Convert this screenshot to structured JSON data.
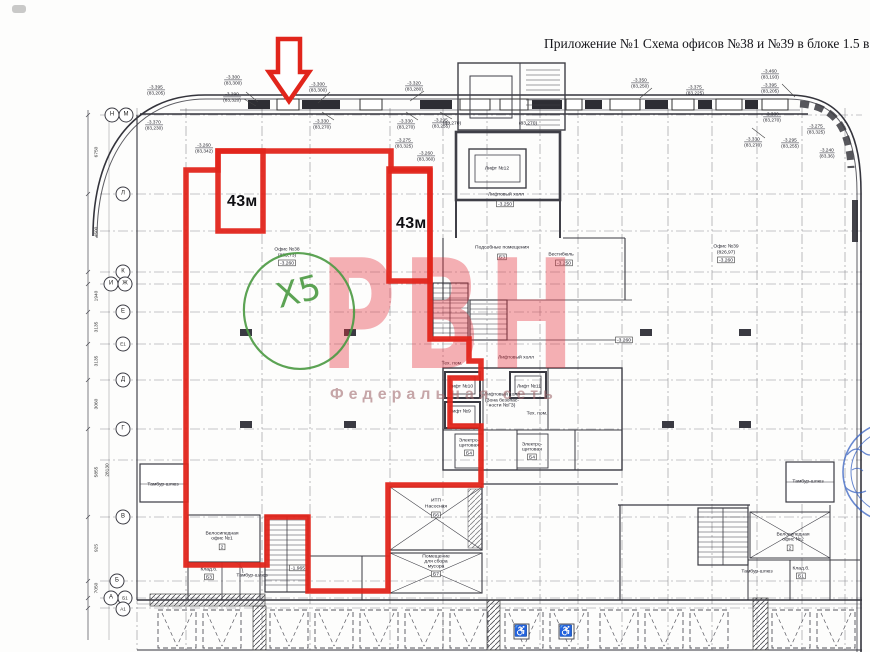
{
  "document": {
    "title": "Приложение №1 Схема офисов №38 и №39 в блоке 1.5 в"
  },
  "markup": {
    "area_label_1": "43м",
    "area_label_2": "43м",
    "green_mark": "Х5"
  },
  "watermark": {
    "logo": "РВН",
    "subtitle": "Федеральная сеть"
  },
  "offices": [
    {
      "name": "Офис №38",
      "area": "(835,73)",
      "elevation": "-3.260"
    },
    {
      "name": "Офис №39",
      "area": "(826,97)",
      "elevation": "-3.260"
    }
  ],
  "rooms": [
    {
      "label": "Лифт №12"
    },
    {
      "label": "Лифтовый холл"
    },
    {
      "label": "-3.250"
    },
    {
      "label": "Подсобные помещения"
    },
    {
      "label": "Б3"
    },
    {
      "label": "Вестибюль"
    },
    {
      "label": "-3.250"
    },
    {
      "label": "Лифтовый холл"
    },
    {
      "label": "Тех. пом."
    },
    {
      "label": "Лифт №10"
    },
    {
      "label": "Лифт №9"
    },
    {
      "label": "Лифт №11"
    },
    {
      "label": "Лифтовый холл"
    },
    {
      "label": "(Зона безопас-"
    },
    {
      "label": "ности №ГЗ)"
    },
    {
      "label": "Тех. пом."
    },
    {
      "label": "Электро-"
    },
    {
      "label": "щитовая"
    },
    {
      "label": "Б4"
    },
    {
      "label": "Электро-"
    },
    {
      "label": "щитовая"
    },
    {
      "label": "Б4"
    },
    {
      "label": "ИТП"
    },
    {
      "label": "Насосная"
    },
    {
      "label": "Б6"
    },
    {
      "label": "Помещение"
    },
    {
      "label": "для сбора"
    },
    {
      "label": "мусора"
    },
    {
      "label": "Б7"
    },
    {
      "label": "Велосипедная"
    },
    {
      "label": "офис №1"
    },
    {
      "label": "2"
    },
    {
      "label": "Велосипедная"
    },
    {
      "label": "офис №2"
    },
    {
      "label": "2"
    },
    {
      "label": "Клад.б."
    },
    {
      "label": "Б3"
    },
    {
      "label": "Клад.б."
    },
    {
      "label": "Б1"
    },
    {
      "label": "Тамбур-шлюз"
    },
    {
      "label": "Тамбур-шлюз"
    },
    {
      "label": "Тамбур-шлюз"
    },
    {
      "label": "Тамбур-шлюз"
    },
    {
      "label": "-1.965"
    },
    {
      "label": "-3.260"
    },
    {
      "label": "(83,270)"
    },
    {
      "label": "(83,270)"
    }
  ],
  "elevations": [
    {
      "value": "-3.395",
      "mark": "(83,205)"
    },
    {
      "value": "-3.370",
      "mark": "(83,230)"
    },
    {
      "value": "-3.300",
      "mark": "(83,300)"
    },
    {
      "value": "-3.290",
      "mark": "(83,320)"
    },
    {
      "value": "-3.260",
      "mark": "(83,342)"
    },
    {
      "value": "-3.300",
      "mark": "(83,300)"
    },
    {
      "value": "-3.330",
      "mark": "(83,270)"
    },
    {
      "value": "-3.320",
      "mark": "(83,280)"
    },
    {
      "value": "-3.330",
      "mark": "(83,270)"
    },
    {
      "value": "-3.295",
      "mark": "(83,255)"
    },
    {
      "value": "-3.275",
      "mark": "(83,325)"
    },
    {
      "value": "-3.260",
      "mark": "(83,360)"
    },
    {
      "value": "-3.350",
      "mark": "(83,250)"
    },
    {
      "value": "-3.375",
      "mark": "(83,225)"
    },
    {
      "value": "-3.460",
      "mark": "(83,193)"
    },
    {
      "value": "-3.395",
      "mark": "(83,205)"
    },
    {
      "value": "-3.330",
      "mark": "(83,270)"
    },
    {
      "value": "-3.330",
      "mark": "(83,270)"
    },
    {
      "value": "-3.295",
      "mark": "(83,255)"
    },
    {
      "value": "-3.275",
      "mark": "(83,325)"
    },
    {
      "value": "-3.240",
      "mark": "(83,36)"
    }
  ],
  "axes": [
    {
      "label": "Н"
    },
    {
      "label": "М"
    },
    {
      "label": "Л"
    },
    {
      "label": "К"
    },
    {
      "label": "И"
    },
    {
      "label": "Ж"
    },
    {
      "label": "Е"
    },
    {
      "label": "Е1"
    },
    {
      "label": "Д"
    },
    {
      "label": "Г"
    },
    {
      "label": "В"
    },
    {
      "label": "Б"
    },
    {
      "label": "А"
    },
    {
      "label": "Б1"
    },
    {
      "label": "А1"
    }
  ],
  "dims": [
    "6750",
    "4500",
    "1940",
    "3135",
    "3135",
    "3060",
    "5855",
    "925",
    "7050",
    "28130"
  ],
  "icons": {
    "wheelchair": "♿"
  },
  "colors": {
    "outline_red": "#e1251b",
    "annotation_green": "#4b9a42",
    "watermark_pink": "#e4303c",
    "stamp_blue": "#2f5cc0",
    "drawing_ink": "#34343c"
  }
}
